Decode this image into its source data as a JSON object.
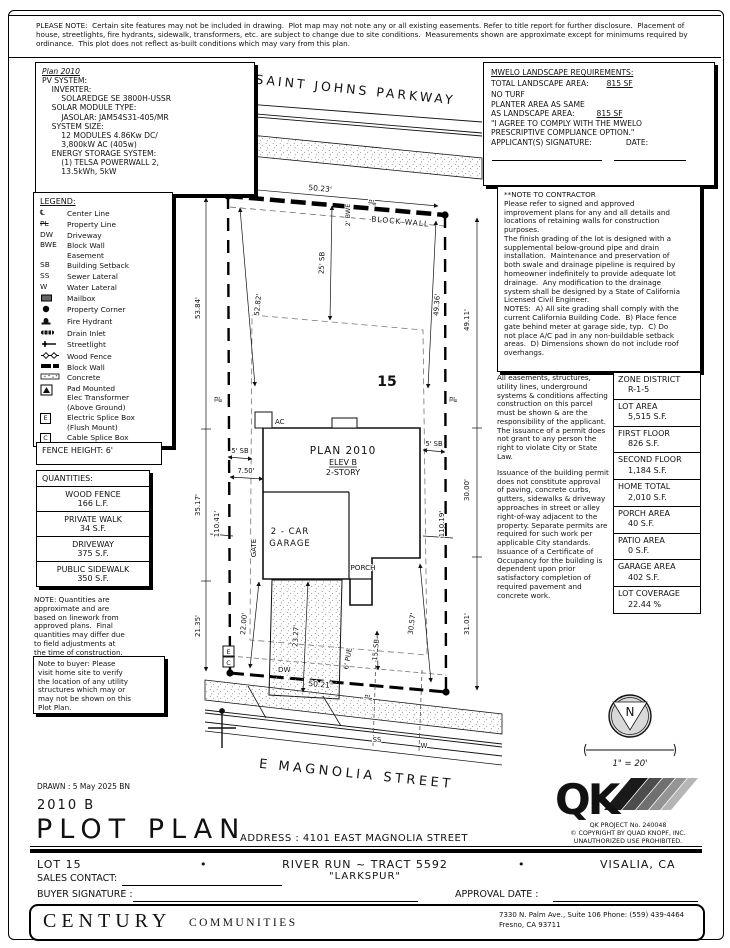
{
  "top_note": "PLEASE NOTE:  Certain site features may not be included in drawing.  Plot map may not note any or all existing easements. Refer to title report for further disclosure.  Placement of house, streetlights, fire hydrants, sidewalk, transformers, etc. are subject to change due to site conditions.  Measurements shown are approximate except for minimums required by ordinance.  This plot does not reflect as-built conditions which may vary from this plan.",
  "pv_box": {
    "title": "Plan 2010",
    "text": "PV SYSTEM:\n    INVERTER:\n        SOLAREDGE SE 3800H-USSR\n    SOLAR MODULE TYPE:\n        JASOLAR: JAM54S31-405/MR\n    SYSTEM SIZE:\n        12 MODULES 4.86Kw DC/\n        3,800kW AC (405w)\n    ENERGY STORAGE SYSTEM:\n        (1) TELSA POWERWALL 2,\n        13.5kWh, 5kW"
  },
  "mwelo": {
    "title": "MWELO LANDSCAPE REQUIREMENTS:",
    "l1": "TOTAL LANDSCAPE AREA:",
    "v1": "815 SF",
    "l2": "NO TURF",
    "l3": "PLANTER AREA AS SAME",
    "l4": "AS LANDSCAPE AREA:",
    "v2": "815 SF",
    "l5": "\"I AGREE TO COMPLY WITH THE MWELO",
    "l6": "PRESCRIPTIVE COMPLIANCE OPTION.\"",
    "l7": "APPLICANT(S) SIGNATURE:",
    "l8": "DATE:"
  },
  "legend": {
    "title": "LEGEND:",
    "items": [
      {
        "sym": "℄",
        "label": "Center Line"
      },
      {
        "sym": "PL",
        "label": "Property Line"
      },
      {
        "sym": "DW",
        "label": "Driveway"
      },
      {
        "sym": "BWE",
        "label": "Block Wall\nEasement"
      },
      {
        "sym": "SB",
        "label": "Building Setback"
      },
      {
        "sym": "SS",
        "label": "Sewer Lateral"
      },
      {
        "sym": "W",
        "label": "Water Lateral"
      },
      {
        "sym": "",
        "label": "Mailbox"
      },
      {
        "sym": "",
        "label": "Property Corner"
      },
      {
        "sym": "",
        "label": "Fire Hydrant"
      },
      {
        "sym": "",
        "label": "Drain Inlet"
      },
      {
        "sym": "",
        "label": "Streetlight"
      },
      {
        "sym": "",
        "label": "Wood Fence"
      },
      {
        "sym": "",
        "label": "Block Wall"
      },
      {
        "sym": "",
        "label": "Concrete"
      },
      {
        "sym": "",
        "label": "Pad Mounted\nElec Transformer\n(Above Ground)"
      },
      {
        "sym": "E",
        "label": "Electric Splice Box\n(Flush Mount)"
      },
      {
        "sym": "C",
        "label": "Cable Splice Box"
      }
    ]
  },
  "contractor_note": "**NOTE TO CONTRACTOR\nPlease refer to signed and approved\nimprovement plans for any and all details and\nlocations of retaining walls for construction\npurposes.\nThe finish grading of the lot is designed with a\nsupplemental below-ground pipe and drain\ninstallation.  Maintenance and preservation of\nboth swale and drainage pipeline is required by\nhomeowner indefinitely to provide adequate lot\ndrainage.  Any modification to the drainage\nsystem shall be designed by a State of California\nLicensed Civil Engineer.\nNOTES:  A) All site grading shall comply with the\ncurrent California Building Code.  B) Place fence\ngate behind meter at garage side, typ.  C) Do\nnot place A/C pad in any non-buildable setback\nareas.  D) Dimensions shown do not include roof\noverhangs.",
  "easements_p1": "All easements, structures, utility lines, underground systems & conditions affecting construction on this parcel must be shown & are the responsibility of the applicant. The issuance of a permit does not grant to any person the right to violate City or State Law.",
  "easements_p2": "Issuance of the building permit does not constitute approval of paving, concrete curbs, gutters, sidewalks & driveway approaches in street or alley right-of-way adjacent to the property. Separate permits are required for such work per applicable City standards. Issuance of a Certificate of Occupancy for the building is dependent upon prior satisfactory completion of required pavement and concrete work.",
  "zone_table": {
    "rows": [
      {
        "label": "ZONE DISTRICT",
        "value": "R-1-5"
      },
      {
        "label": "LOT AREA",
        "value": "5,515 S.F."
      },
      {
        "label": "FIRST FLOOR",
        "value": "826 S.F."
      },
      {
        "label": "SECOND FLOOR",
        "value": "1,184 S.F."
      },
      {
        "label": "HOME TOTAL",
        "value": "2,010 S.F."
      },
      {
        "label": "PORCH AREA",
        "value": "40 S.F."
      },
      {
        "label": "PATIO AREA",
        "value": "0 S.F."
      },
      {
        "label": "GARAGE AREA",
        "value": "402 S.F."
      },
      {
        "label": "LOT COVERAGE",
        "value": "22.44 %"
      }
    ]
  },
  "fence": {
    "text": "FENCE HEIGHT: 6'"
  },
  "quantities": {
    "title": "QUANTITIES:",
    "rows": [
      {
        "label": "WOOD FENCE",
        "value": "166 L.F."
      },
      {
        "label": "PRIVATE WALK",
        "value": "34 S.F."
      },
      {
        "label": "DRIVEWAY",
        "value": "375 S.F."
      },
      {
        "label": "PUBLIC SIDEWALK",
        "value": "350 S.F."
      }
    ]
  },
  "quantities_note": "NOTE: Quantities are\napproximate and are\nbased on linework from\napproved plans.  Final\nquantities may differ due\nto field adjustments at\nthe time of construction.",
  "buyer_note": "Note to buyer: Please\nvisit home site to verify\nthe location of any utility\nstructures which may or\nmay not be shown on this\nPlot Plan.",
  "north": {
    "n": "N",
    "scale": "1\" = 20'"
  },
  "qk": {
    "logo": "QK",
    "project": "QK PROJECT No. 240048",
    "copyright1": "©  COPYRIGHT BY QUAD KNOPF, INC.",
    "copyright2": "UNAUTHORIZED USE PROHIBITED."
  },
  "drawing": {
    "street_top": "SAINT JOHNS PARKWAY",
    "street_bottom": "E MAGNOLIA STREET",
    "lot_number": "15",
    "block_wall": "BLOCK WALL",
    "plan": "PLAN 2010",
    "elev": "ELEV B",
    "story": "2-STORY",
    "garage1": "2 - CAR",
    "garage2": "GARAGE",
    "porch": "PORCH",
    "ac": "AC",
    "dw": "DW",
    "gate": "GATE",
    "pl": "PL",
    "ss": "SS",
    "w": "W",
    "e": "E",
    "c": "C",
    "dims": {
      "top": "50.23'",
      "bwe": "2' BWE",
      "sb25": "25' SB",
      "left_outer": "53.84'",
      "left_inner": "52.82'",
      "right_inner": "49.36'",
      "right_outer": "49.11'",
      "sb5_left": "5' SB",
      "sb5_right": "5' SB",
      "d750": "7.50'",
      "d3517": "35.17'",
      "e11041": "110.41'",
      "d3000": "30.00'",
      "e11019": "110.19'",
      "d2135": "21.35'",
      "d2200": "22.00'",
      "d2327": "23.27'",
      "pue": "6' PUE",
      "sb15": "15' SB",
      "d3057": "30.57'",
      "d3101": "31.01'",
      "bottom": "50.21'"
    }
  },
  "titleblock": {
    "drawn": "DRAWN : 5 May 2025  BN",
    "plan_code": "2010 B",
    "title": "PLOT PLAN",
    "address": "ADDRESS :  4101 EAST MAGNOLIA STREET",
    "lot": "LOT 15",
    "bullet1": "•",
    "bullet2": "•",
    "tract": "RIVER RUN ~ TRACT 5592",
    "tract_name": "\"LARKSPUR\"",
    "city": "VISALIA, CA",
    "sales": "SALES CONTACT:",
    "buyer": "BUYER SIGNATURE :",
    "approval": "APPROVAL DATE :"
  },
  "footer": {
    "brand": "CENTURY",
    "brand2": "COMMUNITIES",
    "address1": "7330 N. Palm Ave., Suite 106   Phone:  (559) 439-4464",
    "address2": "Fresno, CA  93711"
  }
}
